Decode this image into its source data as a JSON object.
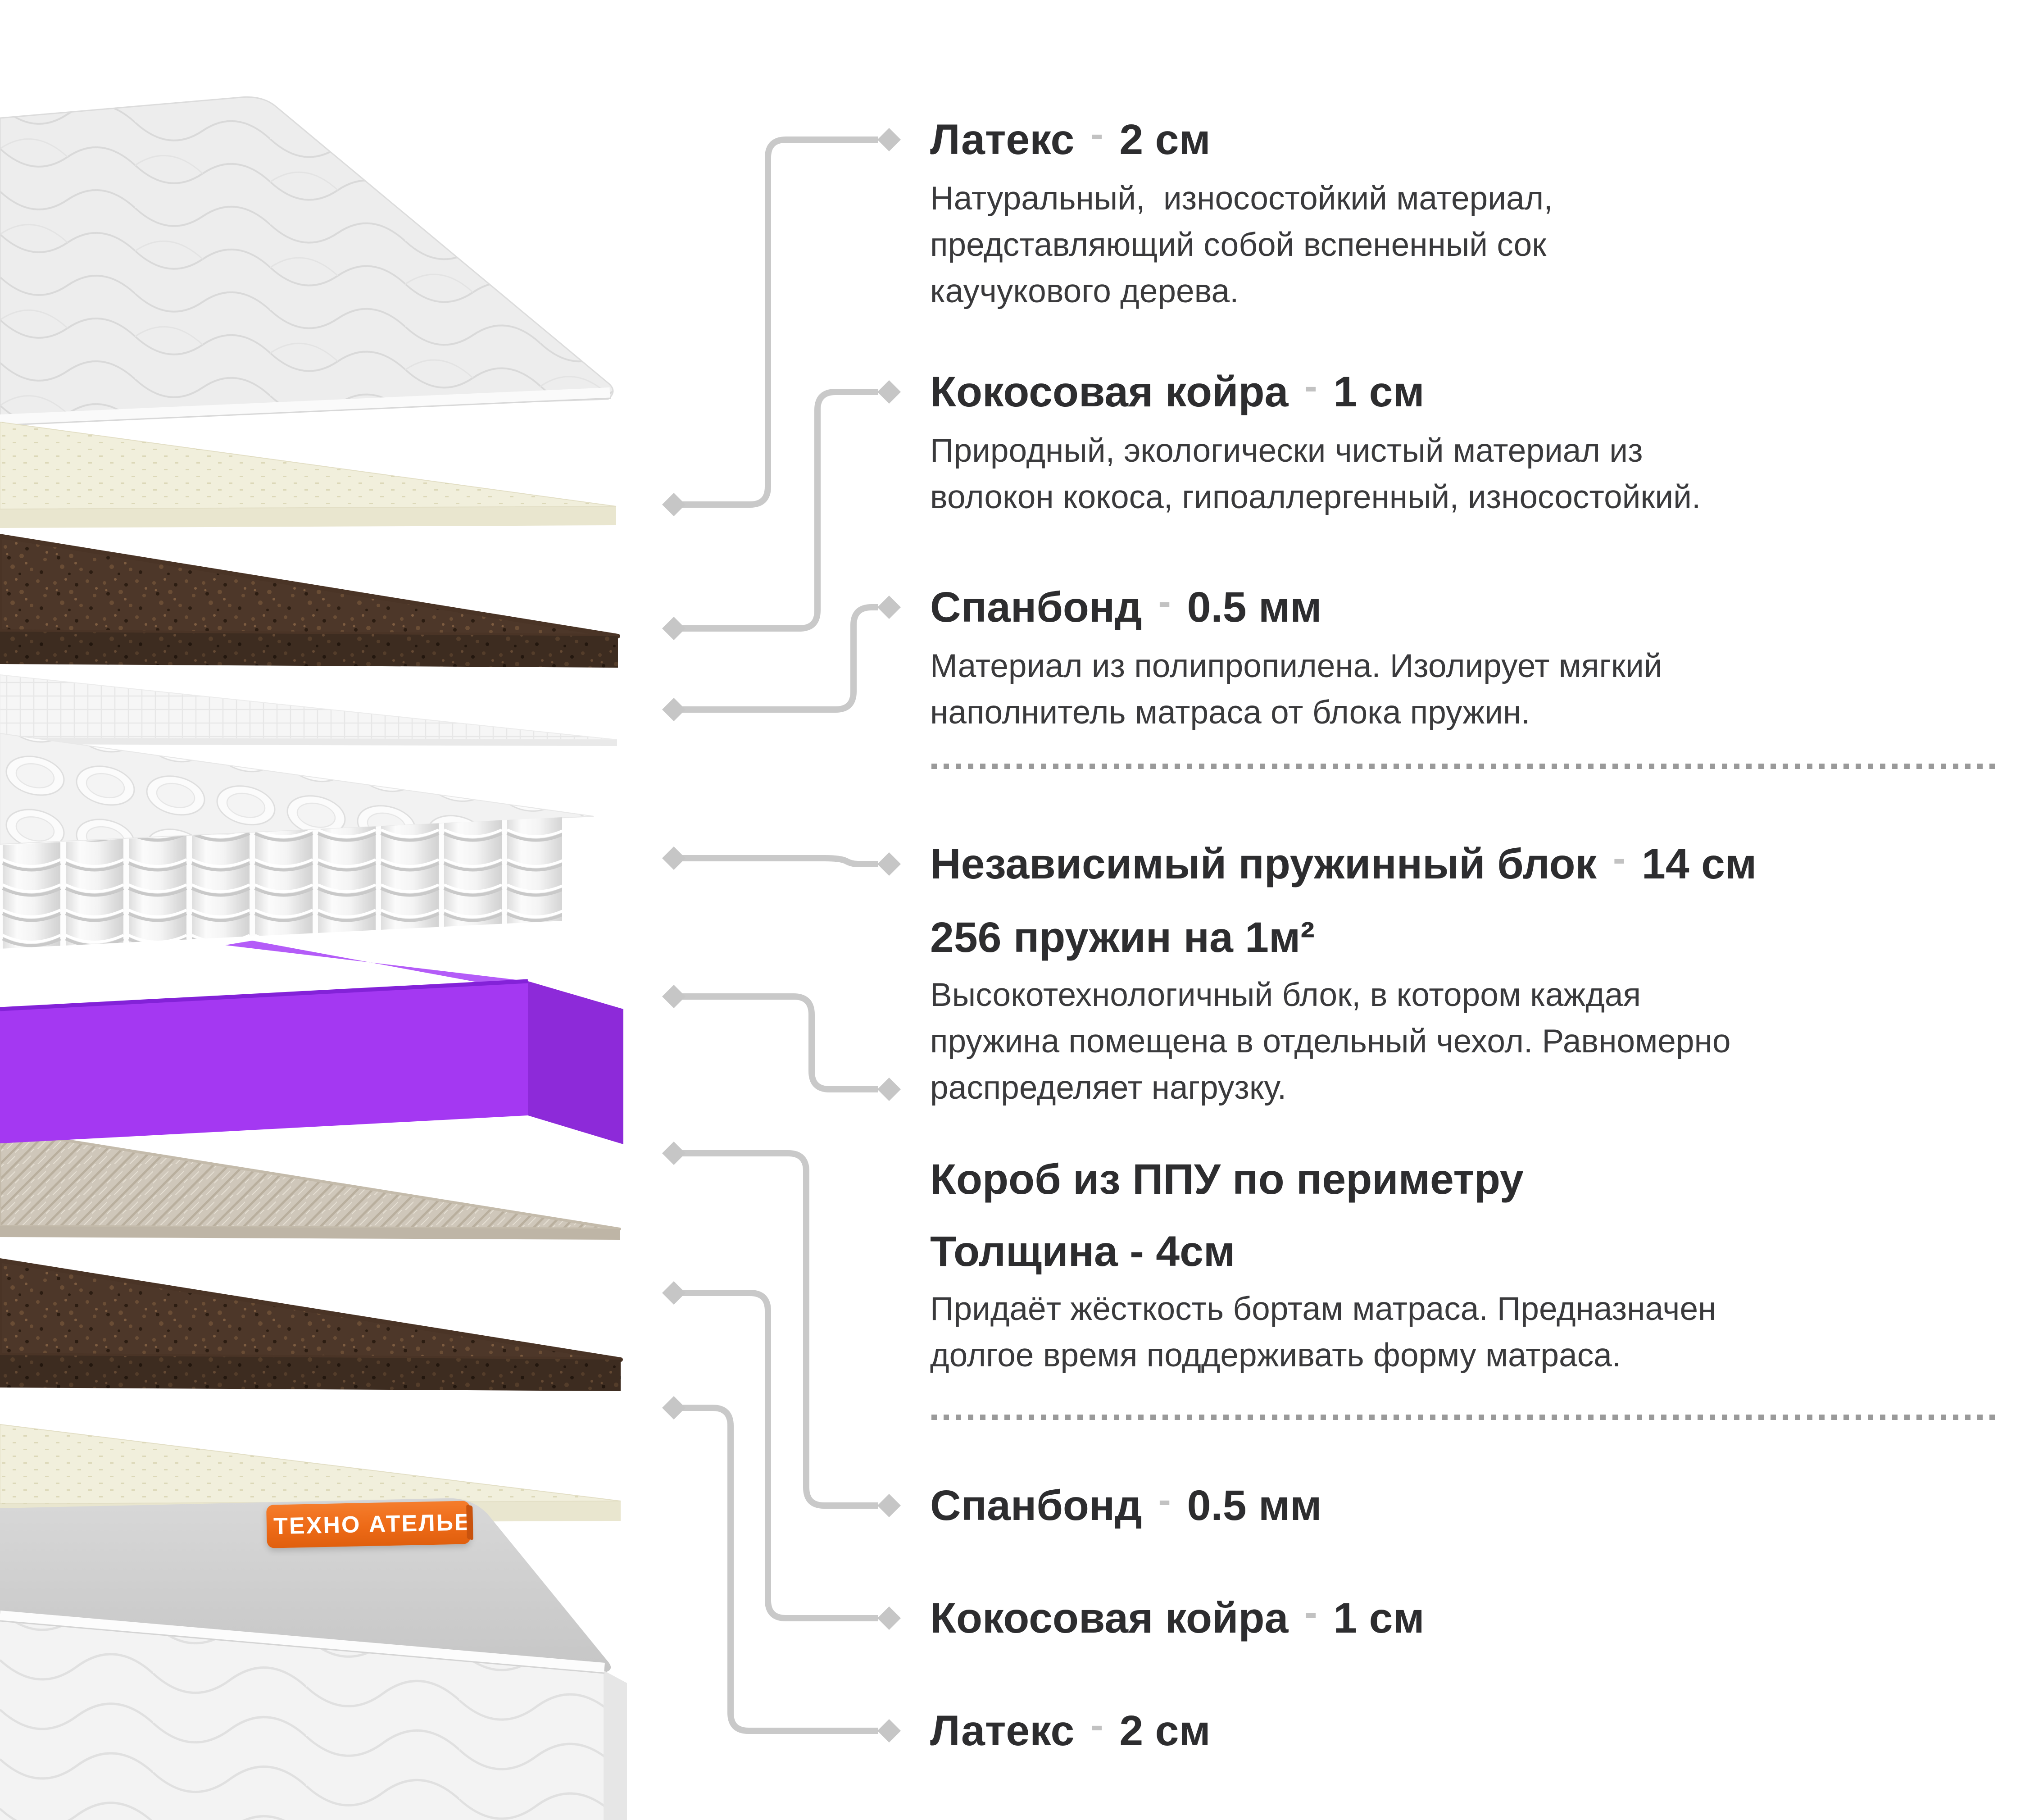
{
  "separator": "-",
  "logo": {
    "text": "ТЕХНО АТЕЛЬЕ"
  },
  "colors": {
    "accent_purple": "#A438F2",
    "brand_orange": "#ED6A17",
    "connector_gray": "#C9C9C9",
    "title_text": "#2D2D2F",
    "body_text": "#3A3A3C"
  },
  "annotations": [
    {
      "name": "Латекс",
      "value": "2 см",
      "body": [
        "Натуральный,  износостойкий материал,",
        "представляющий собой вспененный сок",
        "каучукового дерева."
      ]
    },
    {
      "name": "Кокосовая койра",
      "value": "1 см",
      "body": [
        "Природный, экологически чистый материал из",
        "волокон кокоса, гипоаллергенный, износостойкий."
      ]
    },
    {
      "name": "Спанбонд",
      "value": "0.5 мм",
      "body": [
        "Материал из полипропилена. Изолирует мягкий",
        "наполнитель матраса от блока пружин."
      ]
    },
    {
      "name": "Независимый пружинный блок",
      "value": "14 см",
      "subtitle": "256 пружин на 1м²",
      "body": [
        "Высокотехнологичный блок, в котором каждая",
        "пружина помещена в отдельный чехол. Равномерно",
        "распределяет нагрузку."
      ]
    },
    {
      "name": "Короб из ППУ по периметру",
      "subtitle": "Толщина - 4см",
      "body": [
        "Придаёт жёсткость бортам матраса. Предназначен",
        "долгое время поддерживать форму матраса."
      ]
    },
    {
      "name": "Спанбонд",
      "value": "0.5 мм"
    },
    {
      "name": "Кокосовая койра",
      "value": "1 см"
    },
    {
      "name": "Латекс",
      "value": "2 см"
    }
  ]
}
